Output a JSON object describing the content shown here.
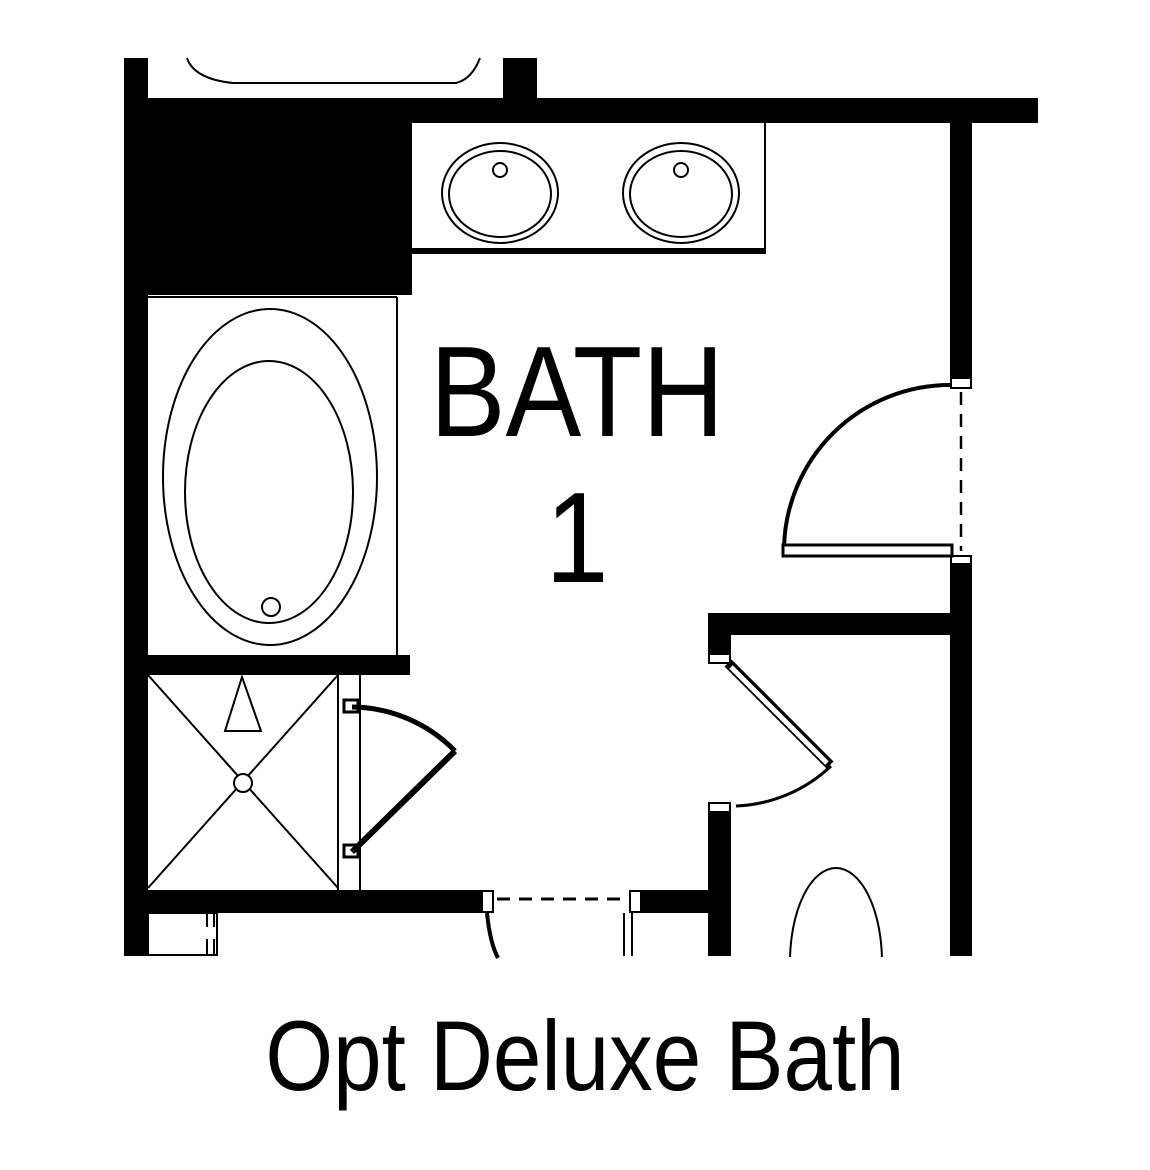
{
  "colors": {
    "background": "#ffffff",
    "ink": "#000000"
  },
  "plan": {
    "room_label": {
      "line1": "BATH",
      "line2": "1"
    }
  },
  "caption": {
    "text": "Opt Deluxe Bath"
  }
}
